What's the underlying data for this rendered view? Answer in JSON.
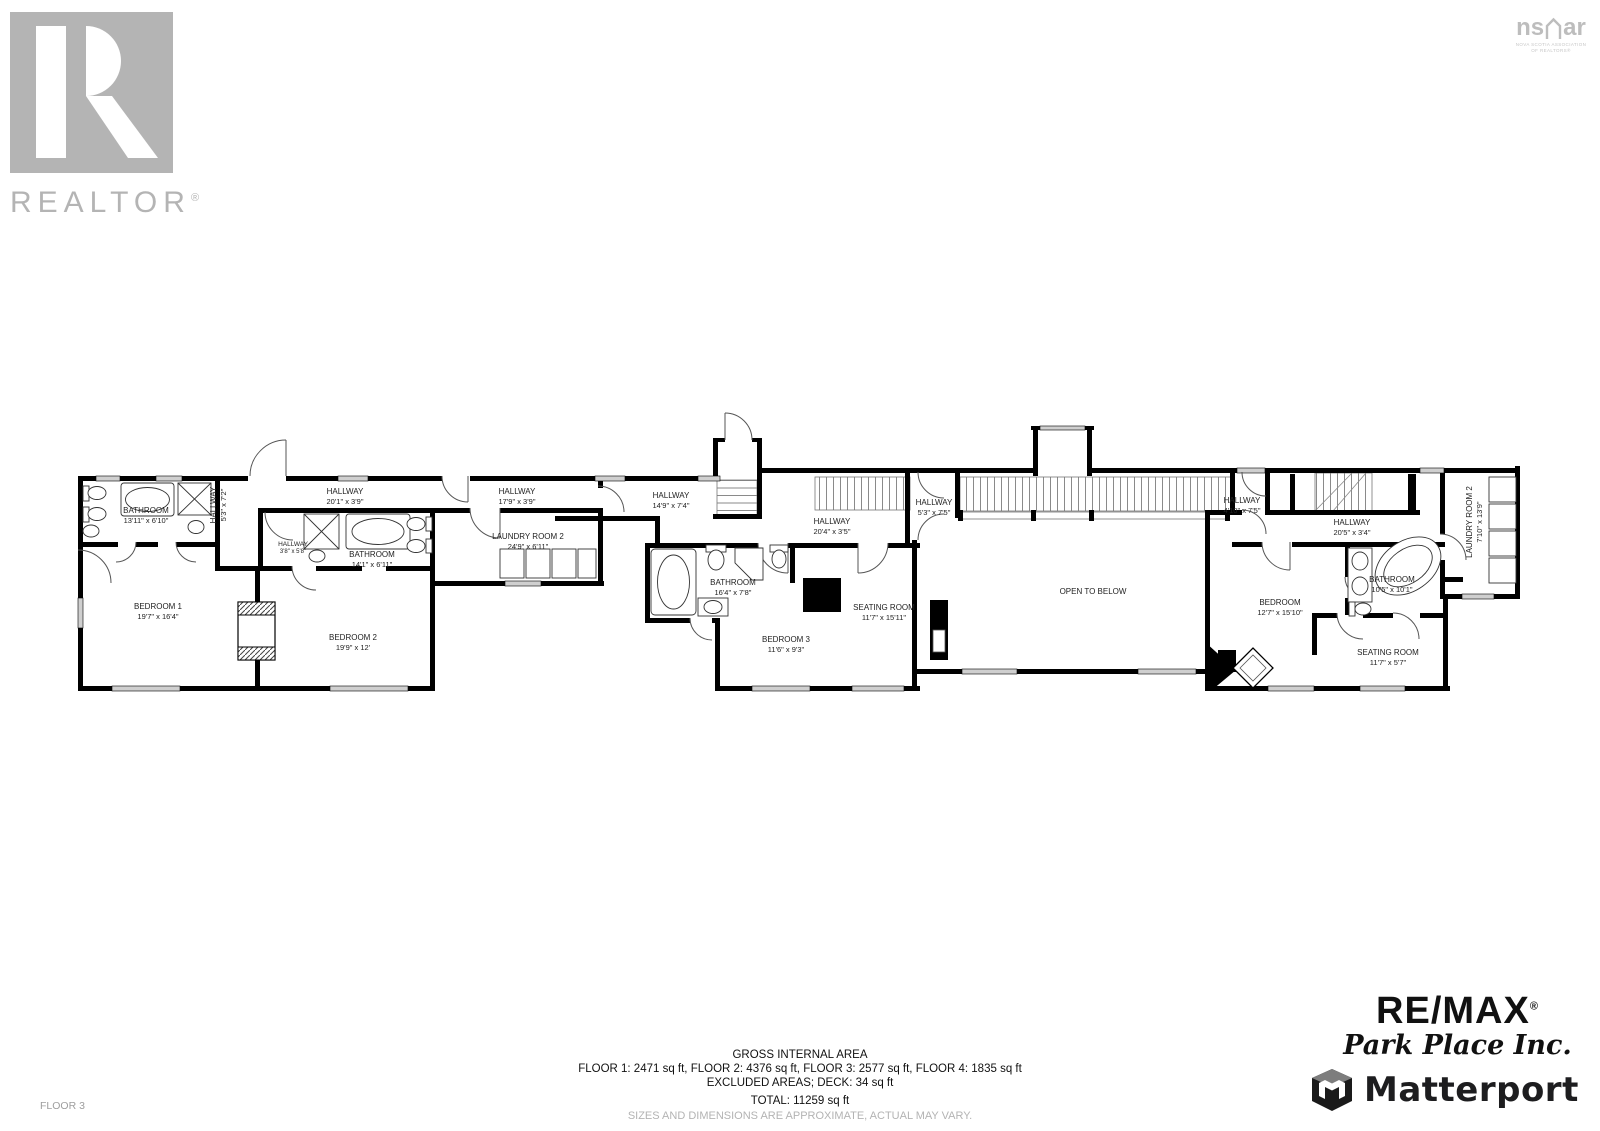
{
  "branding": {
    "realtor": {
      "wordmark": "REALTOR",
      "reg": "®"
    },
    "nsar": {
      "wordmark_left": "ns",
      "wordmark_right": "ar",
      "tagline1": "NOVA SCOTIA ASSOCIATION",
      "tagline2": "OF REALTORS®"
    },
    "remax": {
      "name": "RE/MAX",
      "reg": "®",
      "subtitle": "Park Place Inc."
    },
    "matterport": {
      "name": "Matterport"
    }
  },
  "plan": {
    "floor_label": "FLOOR 3"
  },
  "rooms": [
    {
      "name": "BATHROOM",
      "dims": "13'11\" x 6'10\""
    },
    {
      "name": "HALLWAY",
      "dims": "5'3\" x 7'2\""
    },
    {
      "name": "HALLWAY",
      "dims": "20'1\" x 3'9\""
    },
    {
      "name": "HALLWAY",
      "dims": "3'8\" x 5'8\""
    },
    {
      "name": "BATHROOM",
      "dims": "14'1\" x 6'11\""
    },
    {
      "name": "HALLWAY",
      "dims": "17'9\" x 3'9\""
    },
    {
      "name": "LAUNDRY ROOM 2",
      "dims": "24'9\" x 6'11\""
    },
    {
      "name": "BEDROOM 1",
      "dims": "19'7\" x 16'4\""
    },
    {
      "name": "BEDROOM 2",
      "dims": "19'9\" x 12'"
    },
    {
      "name": "HALLWAY",
      "dims": "14'9\" x 7'4\""
    },
    {
      "name": "HALLWAY",
      "dims": "20'4\" x 3'5\""
    },
    {
      "name": "BATHROOM",
      "dims": "16'4\" x 7'8\""
    },
    {
      "name": "BEDROOM 3",
      "dims": "11'6\" x 9'3\""
    },
    {
      "name": "SEATING ROOM",
      "dims": "11'7\" x 15'11\""
    },
    {
      "name": "HALLWAY",
      "dims": "5'3\" x 7'5\""
    },
    {
      "name": "OPEN TO BELOW",
      "dims": ""
    },
    {
      "name": "HALLWAY",
      "dims": "4'10\" x 7'5\""
    },
    {
      "name": "HALLWAY",
      "dims": "20'5\" x 3'4\""
    },
    {
      "name": "BEDROOM",
      "dims": "12'7\" x 15'10\""
    },
    {
      "name": "BATHROOM",
      "dims": "10'5\" x 10'1\""
    },
    {
      "name": "SEATING ROOM",
      "dims": "11'7\" x 5'7\""
    },
    {
      "name": "LAUNDRY ROOM 2",
      "dims": "7'10\" x 13'9\""
    }
  ],
  "summary": {
    "title": "GROSS INTERNAL AREA",
    "floors": "FLOOR 1: 2471 sq ft, FLOOR 2: 4376 sq ft, FLOOR 3: 2577 sq ft, FLOOR 4: 1835 sq ft",
    "excluded": "EXCLUDED AREAS; DECK: 34 sq ft",
    "total": "TOTAL: 11259 sq ft",
    "disclaimer": "SIZES AND DIMENSIONS ARE APPROXIMATE, ACTUAL MAY VARY."
  },
  "colors": {
    "wall": "#000000",
    "window": "#cfcfcf",
    "brand_gray": "#b4b4b4",
    "text": "#1a1a1a",
    "disclaimer_gray": "#b3b3b3"
  }
}
